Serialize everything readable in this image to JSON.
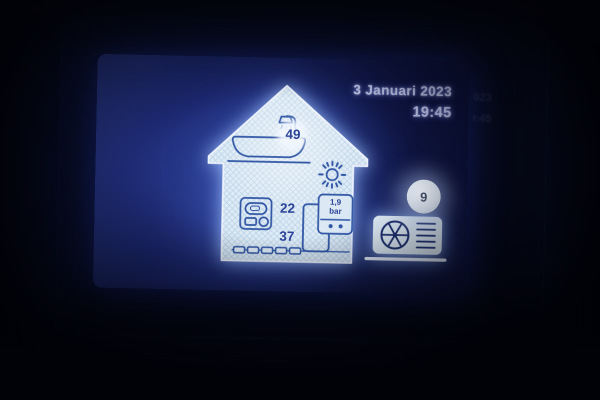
{
  "screen": {
    "header": {
      "date": "3 Januari 2023",
      "time": "19:45"
    },
    "house": {
      "dhw_temperature": "49",
      "room_temperature": "22",
      "flow_temperature": "37",
      "pressure_value": "1,9",
      "pressure_unit": "bar"
    },
    "outdoor": {
      "temperature": "9"
    }
  },
  "icons": {
    "bath-shower-icon": "bathtub with shower head (domestic hot water)",
    "sun-icon": "sun with rays",
    "thermostat-icon": "room thermostat unit",
    "cylinder-icon": "hot water cylinder / radiator column",
    "pressure-gauge-icon": "box showing water pressure with two dots",
    "underfloor-heating-icon": "chain of floor heating loops",
    "heat-pump-icon": "outdoor heat pump unit with fan and vents",
    "led-strip": "glowing vertical light bar on device bezel"
  },
  "colors": {
    "screen_blue": "#1c2870",
    "house_fill": "#dce9f4",
    "hatch_line": "#a6c6e0",
    "icon_blue": "#2f55a4",
    "text_light": "#c7cdf4",
    "number_blue": "#2c4399",
    "led_glow": "#3f5bff",
    "glow_white": "#eef4ff"
  }
}
